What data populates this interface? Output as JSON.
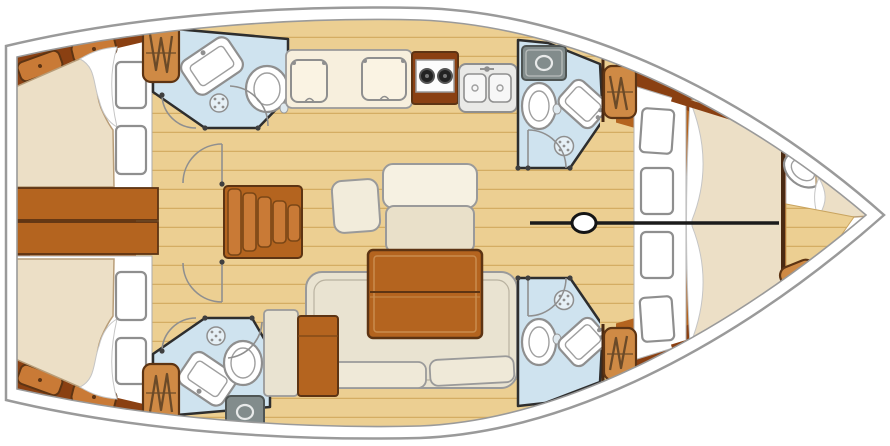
{
  "title": "Sailing yacht interior layout plan (top-down, bow to the right)",
  "palette": {
    "wood": "#b4641f",
    "wood_dark": "#8a4012",
    "wood_light": "#c97a36",
    "locker": "#cf8a45",
    "floor": "#eccf92",
    "floor_grain": "#d4ad63",
    "bath": "#cfe3ef",
    "wall": "#2e2e2e",
    "mattress": "#ecdfc6",
    "cream": "#e9e3d1",
    "appliance": "#828c8c",
    "hull_line": "#9a9a9a",
    "centerline": "#1b1b1b"
  },
  "vessel": {
    "view": "deck plan",
    "orientation": "bow right, stern left",
    "rooms": [
      {
        "name": "aft-cabin-port",
        "fixtures": [
          "double-berth",
          "pillows",
          "storage-hatches",
          "hanging-locker"
        ]
      },
      {
        "name": "aft-head-port",
        "fixtures": [
          "sink",
          "toilet",
          "shower-drain",
          "door"
        ]
      },
      {
        "name": "aft-cabin-starboard",
        "fixtures": [
          "double-berth",
          "pillows",
          "storage-hatches",
          "hanging-locker"
        ]
      },
      {
        "name": "aft-head-starboard",
        "fixtures": [
          "sink",
          "toilet",
          "shower-drain",
          "top-load-locker",
          "door"
        ]
      },
      {
        "name": "galley",
        "fixtures": [
          "locker-doors",
          "two-burner-stove",
          "double-sink"
        ]
      },
      {
        "name": "mid-head-forward-port",
        "fixtures": [
          "top-load-locker",
          "toilet",
          "sink",
          "shower-drain",
          "door"
        ]
      },
      {
        "name": "day-head-forward-starboard",
        "fixtures": [
          "toilet",
          "sink",
          "shower-drain",
          "door"
        ]
      },
      {
        "name": "saloon",
        "fixtures": [
          "dining-table",
          "u-settee",
          "bench-seats",
          "side-cabinet",
          "companionway-stairs",
          "engine-box"
        ]
      },
      {
        "name": "forward-cabin",
        "fixtures": [
          "v-berth",
          "cushions",
          "hanging-lockers",
          "mast"
        ]
      },
      {
        "name": "forepeak",
        "fixtures": [
          "berth",
          "sink",
          "hanging-locker"
        ]
      }
    ],
    "symbols": [
      {
        "name": "hanging-locker-icon",
        "meaning": "wardrobe zigzag"
      },
      {
        "name": "shower-drain-icon",
        "meaning": "circle with dots"
      },
      {
        "name": "door-swing-arc",
        "meaning": "quarter-circle arc"
      },
      {
        "name": "mast-icon",
        "meaning": "oval on centerline"
      }
    ]
  }
}
